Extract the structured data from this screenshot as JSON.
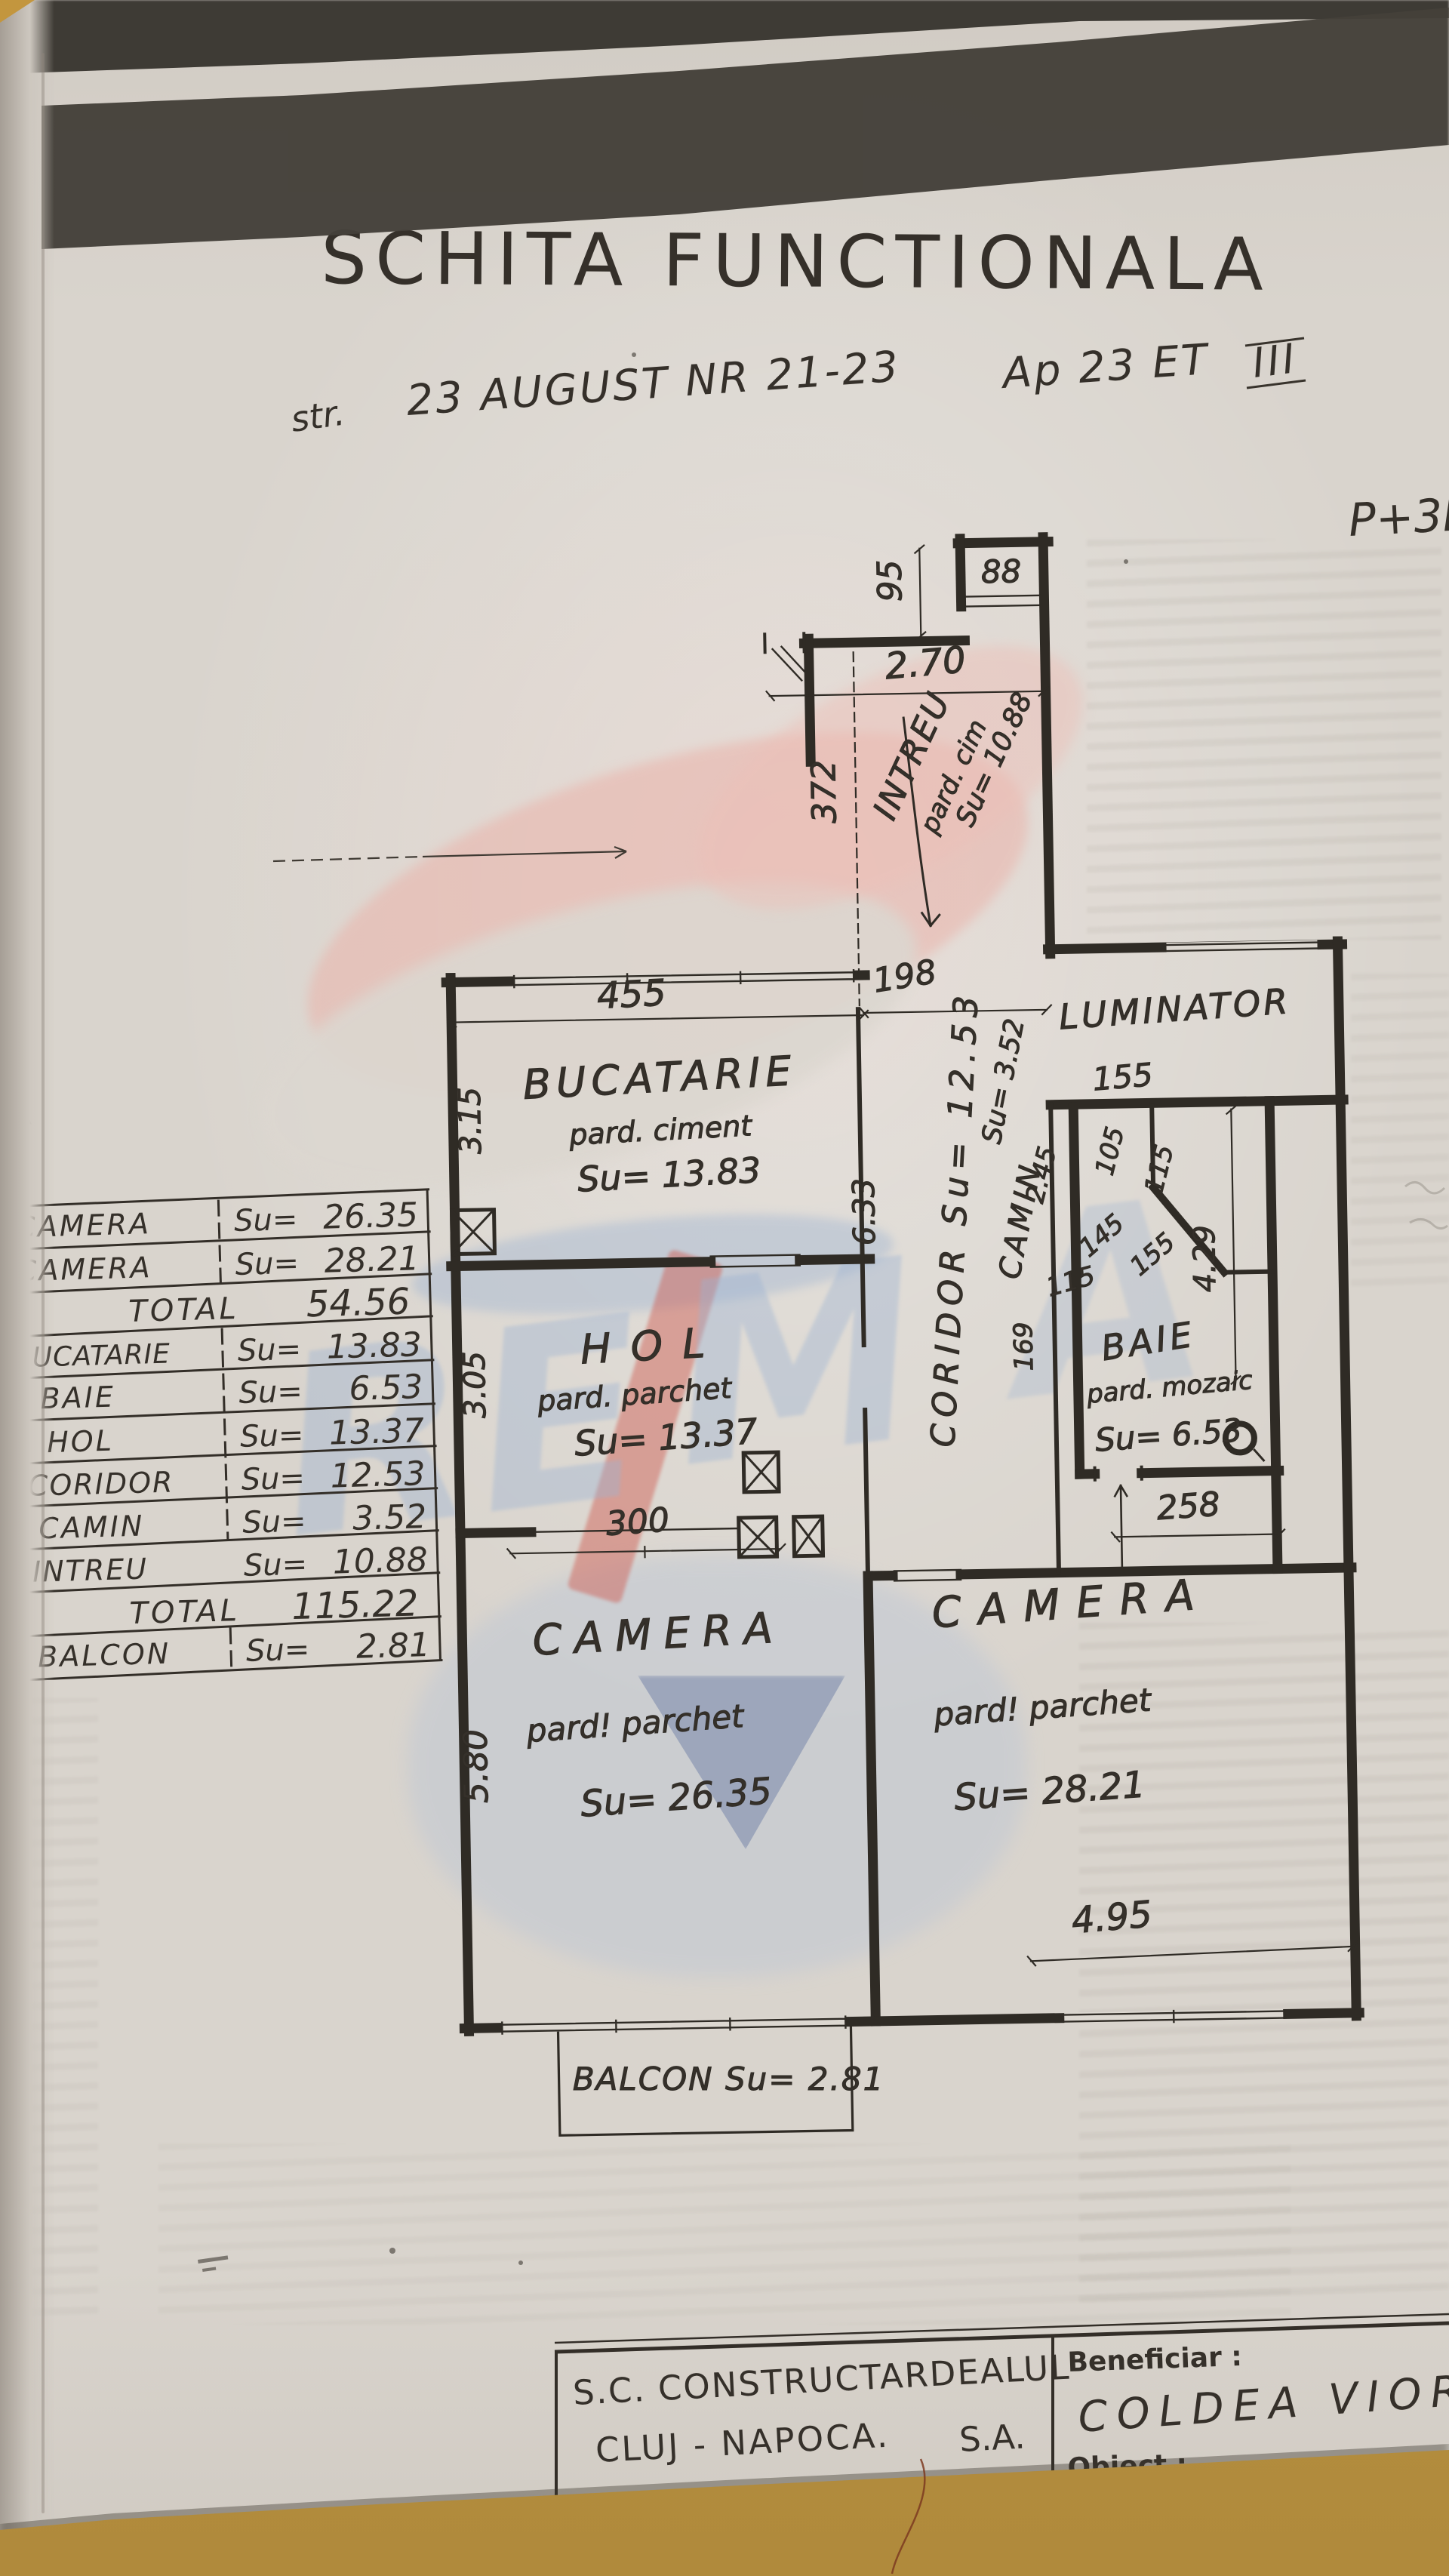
{
  "header": {
    "title": "SCHITA   FUNCTIONALA",
    "addr_str": "str.",
    "addr_main": "23 AUGUST   NR 21-23",
    "addr_ap": "Ap 23    ET",
    "addr_et": "III",
    "floors": "P+3E"
  },
  "plan": {
    "rooms": {
      "bucatarie": {
        "name": "BUCATARIE",
        "floor": "pard. ciment",
        "area": "Su= 13.83"
      },
      "hol": {
        "name": "HOL",
        "floor": "pard. parchet",
        "area": "Su= 13.37"
      },
      "camera_left": {
        "name": "CAMERA",
        "floor": "pard! parchet",
        "area": "Su= 26.35"
      },
      "camera_right": {
        "name": "CAMERA",
        "floor": "pard! parchet",
        "area": "Su= 28.21"
      },
      "baie": {
        "name": "BAIE",
        "floor": "pard. mozaic",
        "area": "Su= 6.53"
      },
      "luminator": {
        "name": "LUMINATOR",
        "width": "155"
      },
      "coridor": {
        "label": "CORIDOR  Su= 12.53"
      },
      "camin": {
        "name": "CAMIN",
        "area": "Su= 3.52"
      },
      "intrare": {
        "name": "INTREU",
        "floor": "pard. cim",
        "area": "Su= 10.88"
      },
      "balcon": {
        "label": "BALCON  Su= 2.81"
      }
    },
    "dims": {
      "d95": "95",
      "d88": "88",
      "d270": "2.70",
      "d372": "372",
      "d198": "198",
      "d455": "455",
      "d315": "3.15",
      "d305": "3.05",
      "d300": "300",
      "d580": "5.80",
      "d495": "4.95",
      "d633": "6.33",
      "d245": "2.45",
      "d105": "105",
      "d115a": "115",
      "d145": "145",
      "d155a": "155",
      "d115b": "115",
      "d169": "169",
      "d429": "4.29",
      "d258": "258",
      "d155lum": "155"
    }
  },
  "table": {
    "rows": [
      {
        "label": "CAMERA",
        "prefix": "Su=",
        "value": "26.35"
      },
      {
        "label": "CAMERA",
        "prefix": "Su=",
        "value": "28.21"
      },
      {
        "label": "TOTAL",
        "prefix": "",
        "value": "54.56"
      },
      {
        "label": "BUCATARIE",
        "prefix": "Su=",
        "value": "13.83"
      },
      {
        "label": "BAIE",
        "prefix": "Su=",
        "value": "6.53"
      },
      {
        "label": "HOL",
        "prefix": "Su=",
        "value": "13.37"
      },
      {
        "label": "CORIDOR",
        "prefix": "Su=",
        "value": "12.53"
      },
      {
        "label": "CAMIN",
        "prefix": "Su=",
        "value": "3.52"
      },
      {
        "label": "INTREU",
        "prefix": "Su=",
        "value": "10.88"
      },
      {
        "label": "TOTAL",
        "prefix": "",
        "value": "115.22"
      },
      {
        "label": "BALCON",
        "prefix": "Su=",
        "value": "2.81"
      }
    ]
  },
  "title_block": {
    "company": "S.C. CONSTRUCTARDEALUL",
    "city": "CLUJ - NAPOCA.",
    "suffix": "S.A.",
    "beneficiar_label": "Beneficiar :",
    "beneficiar_name": "COLDEA VIORIC",
    "obiect_label": "Obiect :"
  },
  "watermark": {
    "re": "RE",
    "m": "M",
    "a": "A",
    "red": "#cf584d",
    "pink": "#eab3aa",
    "blue": "#9db3d2"
  }
}
